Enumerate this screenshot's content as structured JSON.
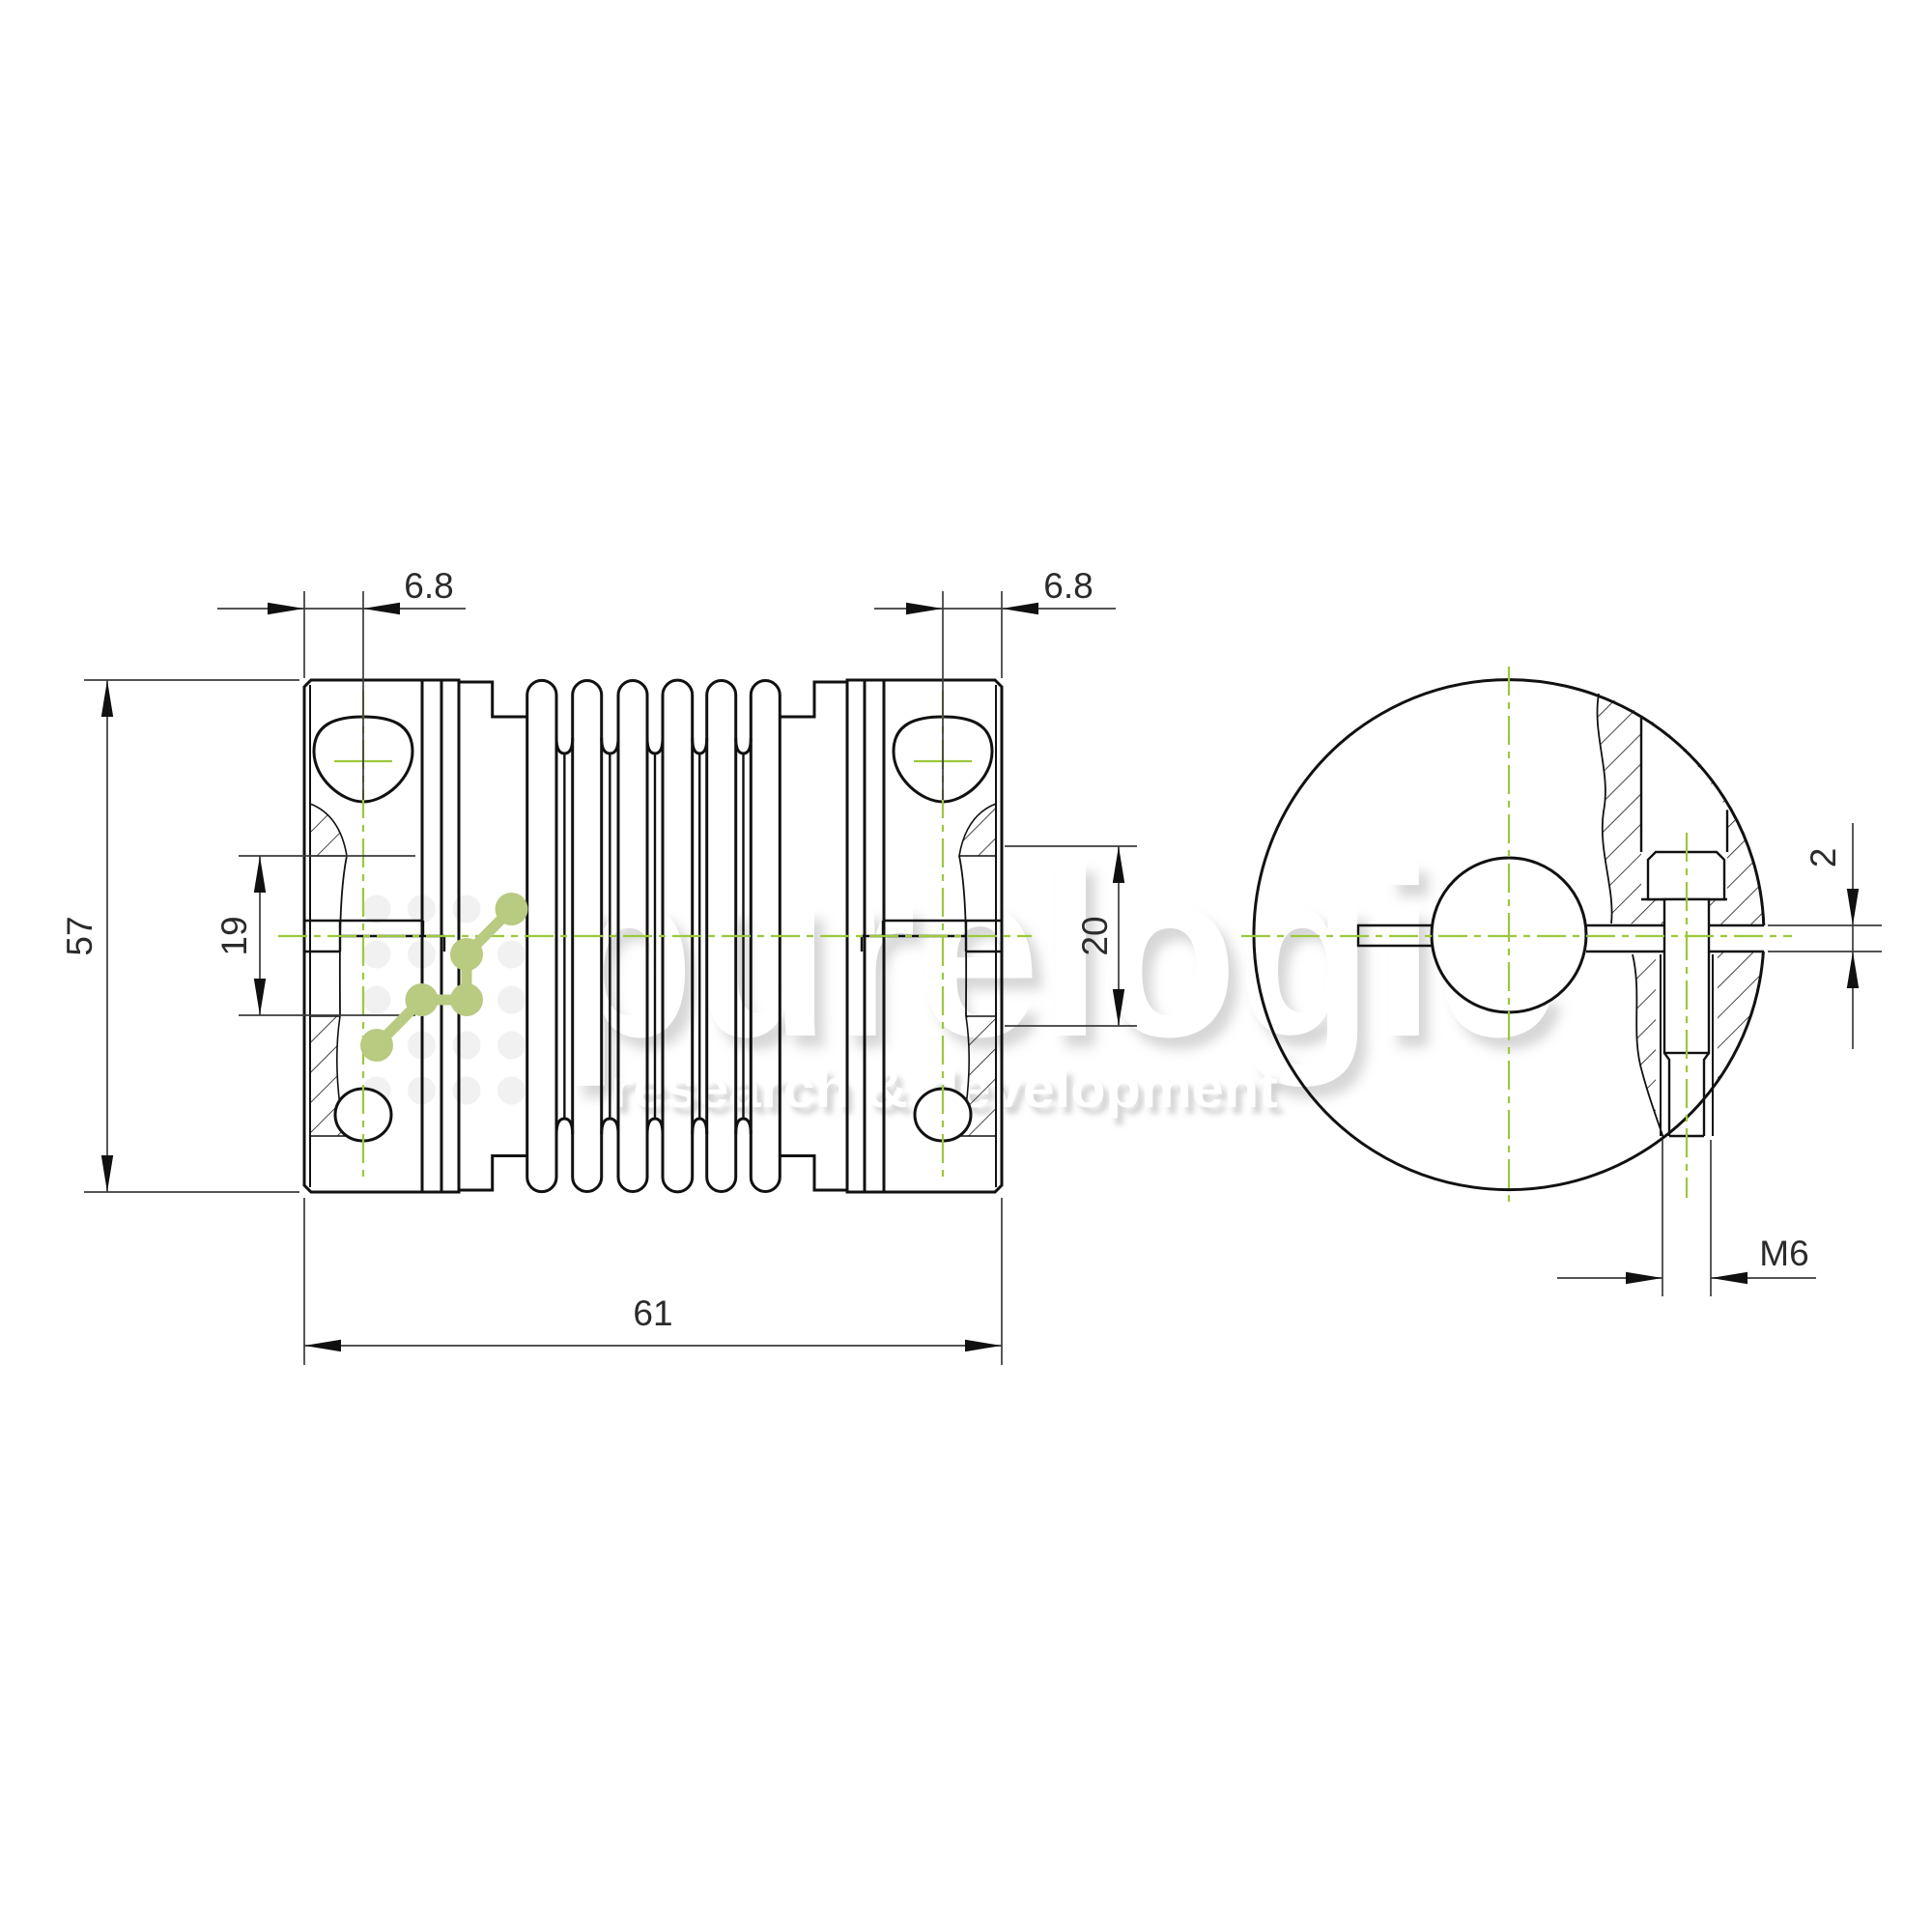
{
  "drawing": {
    "title": "bellows coupling technical drawing",
    "views": {
      "front": "front-section-view",
      "side": "side-end-view"
    },
    "dims": {
      "hub_offset_left": "6.8",
      "hub_offset_right": "6.8",
      "outer_height": "57",
      "inner_span": "19",
      "overall_length": "61",
      "face_span": "20",
      "slit_width": "2",
      "screw_thread": "M6"
    }
  },
  "watermark": {
    "brand": "purelogic",
    "tagline": "research & development"
  },
  "colors": {
    "outline": "#111111",
    "dimension_lines": "#3c3c3c",
    "centerline_green": "#9cc83c",
    "logo_green": "#b9ca81",
    "watermark_shadow": "#c9c9c9",
    "background": "#ffffff"
  }
}
